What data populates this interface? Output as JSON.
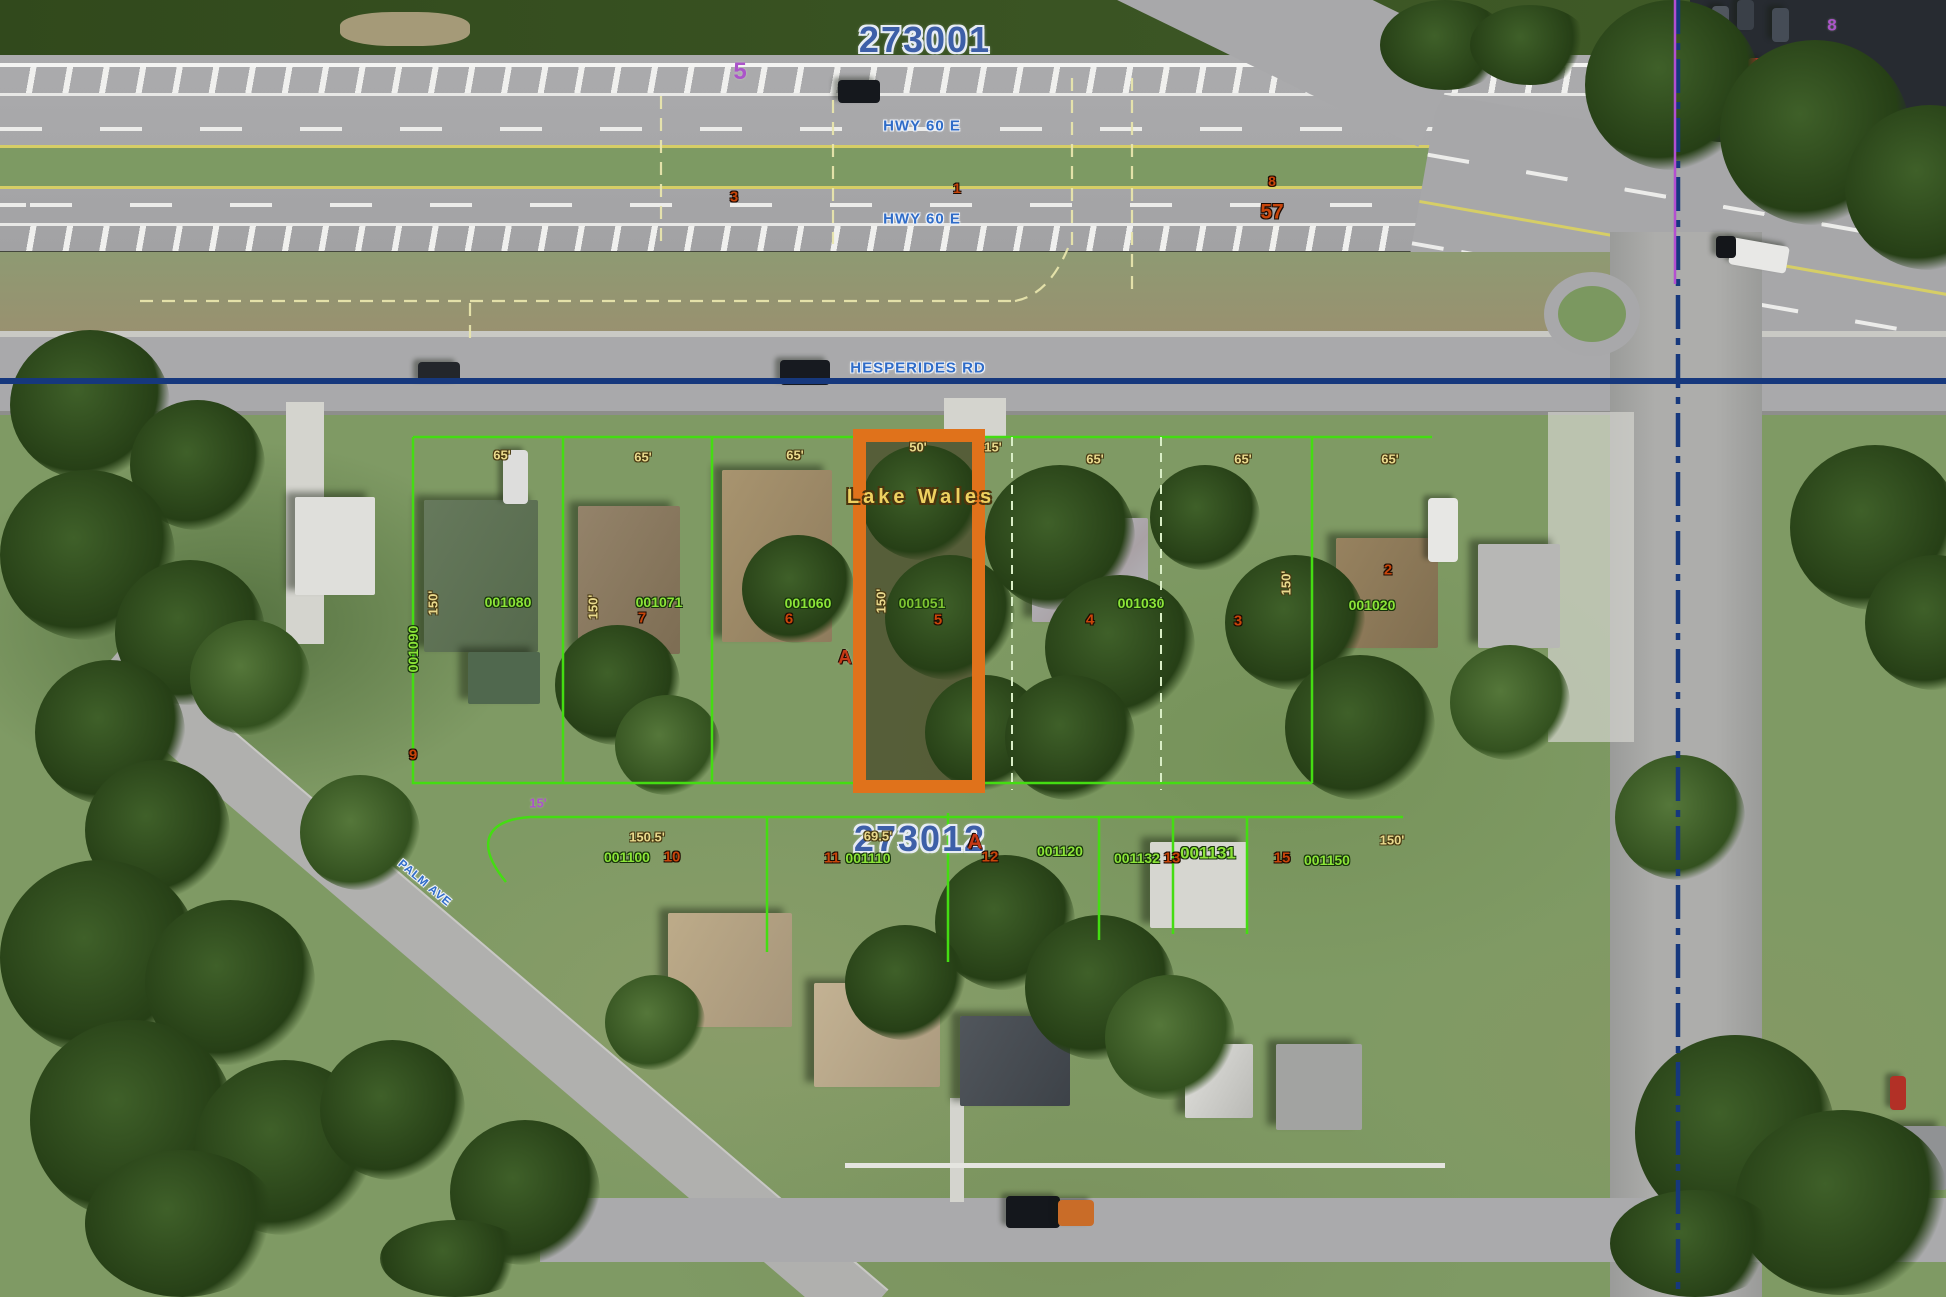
{
  "map": {
    "city_label": "Lake Wales",
    "sections": {
      "north": "273001",
      "south": "273012"
    },
    "roads": {
      "hwy60_upper": "HWY 60 E",
      "hwy60_lower": "HWY 60 E",
      "hesperides": "HESPERIDES RD",
      "palm": "PALM AVE"
    },
    "highlighted_parcel": {
      "id": "001051",
      "lot": "5",
      "frontage": "50'",
      "side_gap": "15'",
      "depth": "150'"
    },
    "north_parcels": [
      {
        "id": "001090",
        "lot": "9"
      },
      {
        "id": "001080",
        "frontage": "65'",
        "depth": "150'"
      },
      {
        "id": "001071",
        "lot": "7",
        "frontage": "65'",
        "depth": "150'"
      },
      {
        "id": "001060",
        "lot": "6",
        "frontage": "65'"
      },
      {
        "id": "001030",
        "lot": "4",
        "frontage": "65'"
      },
      {
        "lot": "3",
        "frontage": "65'",
        "depth": "150'"
      },
      {
        "id": "001020",
        "lot": "2",
        "frontage": "65'"
      }
    ],
    "south_parcels": [
      {
        "id": "001100",
        "lot": "10",
        "frontage": "150.5'"
      },
      {
        "id": "001110",
        "lot": "11",
        "frontage": "69.5'"
      },
      {
        "id": "001120",
        "lot": "12"
      },
      {
        "id": "001132",
        "lot": "13"
      },
      {
        "id": "001131"
      },
      {
        "id": "001150",
        "lot": "15",
        "frontage": "150'"
      }
    ],
    "road_markers": {
      "purple_5": "5",
      "purple_8": "8",
      "purple_15": "15'",
      "orange_3": "3",
      "orange_1": "1",
      "orange_8": "8",
      "orange_57": "57"
    },
    "annotations": {
      "a_north": "A",
      "a_south": "A"
    },
    "colors": {
      "highlight": "#e0721b",
      "parcel_line": "#44dd12",
      "section_text": "#3d5fa8",
      "road_text": "#2f6cc8",
      "dimension_text": "#e9da8d",
      "lot_number_text": "#c8450a",
      "parcel_id_text": "#8ce438",
      "centerline_blue": "#16387d",
      "section_line_purple": "#ab54c9"
    }
  }
}
